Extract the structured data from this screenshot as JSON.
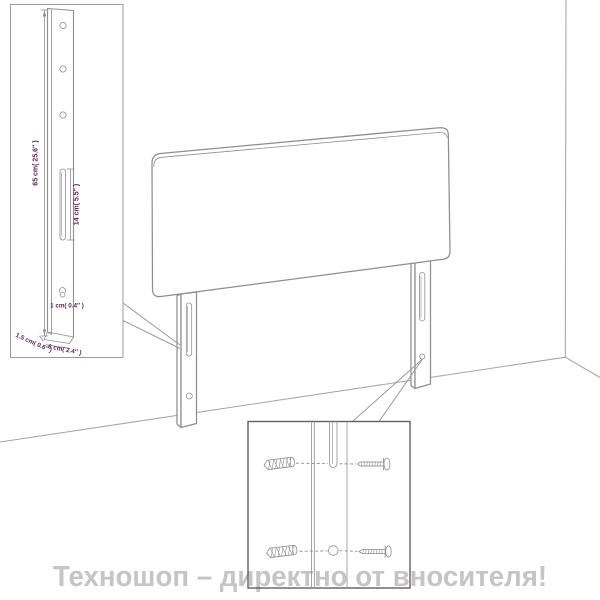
{
  "watermark": {
    "text": "Техношоп – директно от вносителя!"
  },
  "inset_leg_dimensions": {
    "height": "65 cm( 25.6″ )",
    "slot_height": "14 cm( 5.5″ )",
    "hole_diameter": "1 cm( 0.4″ )",
    "leg_thickness": "1.5 cm( 0.6″ )",
    "leg_width": "6 cm( 2.4″ )"
  },
  "colors": {
    "line_art": "#8e8e8e",
    "room_lines": "#a6a6a6",
    "dimension_text": "#59254f",
    "watermark": "#c7c4c4",
    "inset_box_border": "#9a9a9a",
    "detail_box_border": "#606060"
  }
}
